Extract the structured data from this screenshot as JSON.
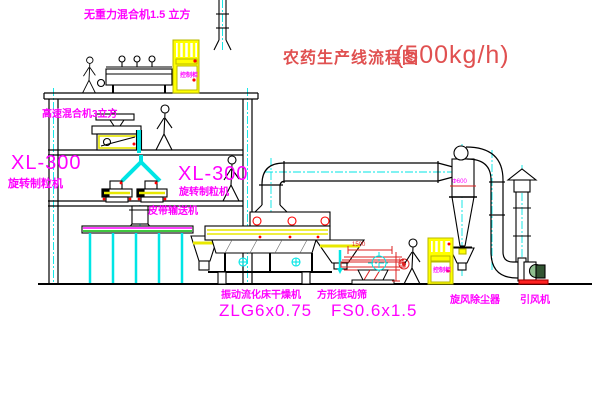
{
  "title": {
    "name": "农药生产线流程图",
    "capacity": "(500kg/h)"
  },
  "equipment_labels": {
    "gravity_mixer": "无重力混合机1.5 立方",
    "mixer2": "高速混合机3立方",
    "granulator_left": {
      "model": "XL-300",
      "name": "旋转制粒机"
    },
    "granulator_mid": {
      "model": "XL-300",
      "name": "旋转制粒机"
    },
    "belt_conveyor": "皮带输送机",
    "dryer": {
      "name": "振动流化床干燥机",
      "model": "ZLG6x0.75"
    },
    "sieve": {
      "name": "方形振动筛",
      "model": "FS0.6x1.5"
    },
    "cyclone": "旋风除尘器",
    "fan": "引风机",
    "cabinet_top": "控制柜",
    "cabinet_right": "控制柜"
  },
  "dimensions": {
    "sieve_length": "1500",
    "sieve_height": "340",
    "cyclone_diameter": "Φ600"
  },
  "colors": {
    "label_magenta": "#ff00ff",
    "line_black": "#000000",
    "centerline_cyan": "#00e5e5",
    "equipment_yellow": "#ffff00",
    "title_red": "#e05050",
    "dim_red": "#dd2222",
    "belt_green": "#00b400"
  }
}
